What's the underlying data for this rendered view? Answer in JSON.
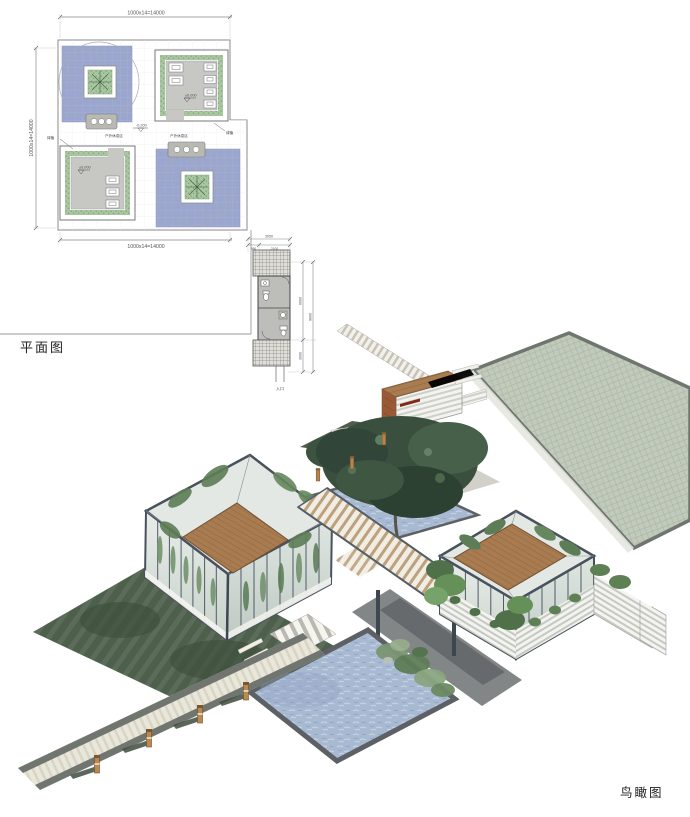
{
  "page": {
    "background": "#ffffff"
  },
  "plan": {
    "title": "平面图",
    "dims": {
      "top": "1000x14=14000",
      "left": "1000x14=14000",
      "bottom": "1000x14=14000",
      "strip_total": "3050",
      "strip_a": "950",
      "strip_b": "2100",
      "strip_right_upper": "6600",
      "strip_right_overall": "9600",
      "strip_right_lower": "3000"
    },
    "levels": {
      "zero": "±0.000",
      "minus": "-0.200"
    },
    "labels": {
      "entrance": "入口",
      "area": "户外休息区",
      "planting": "绿植"
    },
    "colors": {
      "water": "#9aa6cd",
      "planter_green": "#a9c6a1",
      "floor_gray": "#c7c7c3",
      "line": "#777777"
    }
  },
  "birdseye": {
    "title": "鸟瞰图",
    "colors": {
      "plaza_green": "#c1cabb",
      "pool_blue": "#a8b9d2",
      "wood_roof": "#a87c50",
      "frame_dark": "#49525c",
      "shadow_green": "#4e5f4c",
      "tree_green": "#3a4f3d",
      "path_light": "#e9e6da",
      "rust_panel": "#9a5a36"
    }
  }
}
